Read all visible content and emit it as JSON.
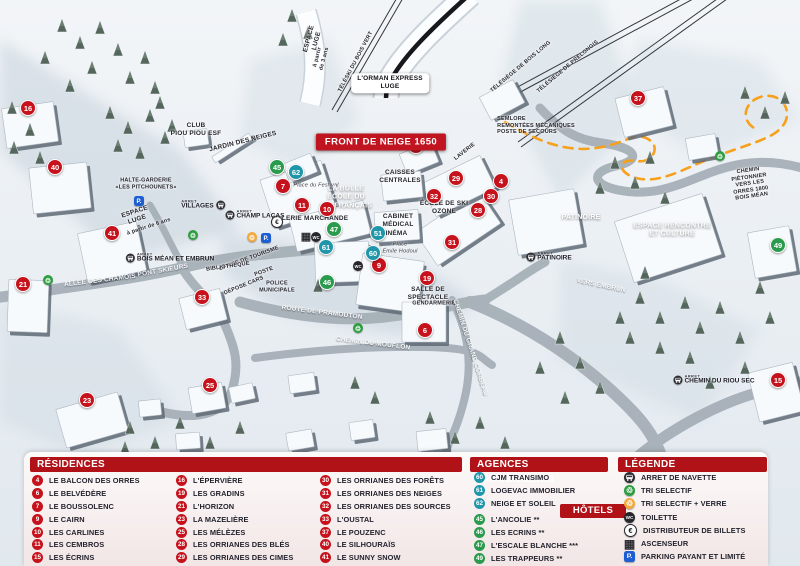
{
  "colors": {
    "header_red": "#b01217",
    "banner_red": "#c01421",
    "marker_red": "#c6121c",
    "marker_green": "#2a9b4c",
    "marker_teal": "#1f96aa",
    "path_orange": "#f6a01b",
    "parking_blue": "#1d5ed2",
    "recycle_green": "#2f9e41",
    "verre_orange": "#f3a93c"
  },
  "map": {
    "banner": {
      "text": "FRONT DE NEIGE 1650"
    },
    "stop_prefix": "ARRET",
    "labels": [
      {
        "t": "ESPACE\nLUGE",
        "x": 313,
        "y": 40,
        "r": -75
      },
      {
        "t": "à partir\nde 3 ans",
        "x": 321,
        "y": 58,
        "r": -75,
        "c": "tiny"
      },
      {
        "t": "TÉLÉSKI DU BOIS VERT",
        "x": 356,
        "y": 62,
        "r": -62,
        "c": "tiny"
      },
      {
        "t": "L'ORMAN EXPRESS\nLUGE",
        "x": 390,
        "y": 83,
        "c": "box"
      },
      {
        "t": "TÉLÉSIÈGE DE BOIS LONG",
        "x": 521,
        "y": 67,
        "r": -40,
        "c": "tiny"
      },
      {
        "t": "TÉLÉSIÈGE DE PRÉLONGIS",
        "x": 568,
        "y": 67,
        "r": -40,
        "c": "tiny"
      },
      {
        "t": "SEMLORE\nREMONTÉES MÉCANIQUES\nPOSTE DE SECOURS",
        "x": 536,
        "y": 126,
        "c": "tiny left"
      },
      {
        "t": "CLUB\nPIOU PIOU ESF",
        "x": 196,
        "y": 130
      },
      {
        "t": "JARDIN DES NEIGES",
        "x": 243,
        "y": 142,
        "r": -14
      },
      {
        "t": "HALTE-GARDERIE\n«LES PITCHOUNETS»",
        "x": 146,
        "y": 184,
        "c": "tiny"
      },
      {
        "t": "ESPACE\nLUGE",
        "x": 136,
        "y": 216,
        "r": -18
      },
      {
        "t": "à partir de 6 ans",
        "x": 149,
        "y": 227,
        "r": -18,
        "c": "tiny"
      },
      {
        "t": "Place du Festival",
        "x": 316,
        "y": 186,
        "c": "place"
      },
      {
        "t": "LA BULLE\nÉCOLE DU\nSKI FRANÇAIS",
        "x": 346,
        "y": 198,
        "c": "white"
      },
      {
        "t": "GALERIE MARCHANDE",
        "x": 310,
        "y": 219
      },
      {
        "t": "OFFICE DE TOURISME",
        "x": 249,
        "y": 259,
        "r": -20,
        "c": "tiny"
      },
      {
        "t": "POSTE",
        "x": 264,
        "y": 272,
        "r": -20,
        "c": "tiny"
      },
      {
        "t": "BIBLIOTHÈQUE",
        "x": 228,
        "y": 267,
        "r": -8,
        "c": "tiny"
      },
      {
        "t": "DÉPOSE CARS",
        "x": 244,
        "y": 286,
        "r": -22,
        "c": "tiny"
      },
      {
        "t": "POLICE\nMUNICIPALE",
        "x": 277,
        "y": 287,
        "c": "tiny"
      },
      {
        "t": "ALLÉE DES CHAMOIS",
        "x": 100,
        "y": 281,
        "r": -7,
        "c": "road"
      },
      {
        "t": "PONT SKIEURS",
        "x": 163,
        "y": 271,
        "r": -10,
        "c": "road"
      },
      {
        "t": "CAISSES\nCENTRALES",
        "x": 400,
        "y": 177
      },
      {
        "t": "LAVERIE",
        "x": 465,
        "y": 152,
        "r": -38,
        "c": "tiny"
      },
      {
        "t": "ÉCOLE DE SKI\nOZONE",
        "x": 444,
        "y": 208
      },
      {
        "t": "CABINET\nMÉDICAL",
        "x": 398,
        "y": 221
      },
      {
        "t": "CINÉMA",
        "x": 394,
        "y": 234
      },
      {
        "t": "Place\nÉmile Hodoul",
        "x": 400,
        "y": 248,
        "c": "place"
      },
      {
        "t": "SALLE DE\nSPECTACLE",
        "x": 428,
        "y": 294
      },
      {
        "t": "GENDARMERIE",
        "x": 434,
        "y": 304,
        "c": "tiny"
      },
      {
        "t": "ROUTE DE PRAMOUTON",
        "x": 322,
        "y": 313,
        "r": 7,
        "c": "road"
      },
      {
        "t": "CHEMIN DU MOUFLON",
        "x": 373,
        "y": 344,
        "r": 7,
        "c": "road"
      },
      {
        "t": "CHEMIN DU GRAND CORBEAU",
        "x": 470,
        "y": 348,
        "r": 72,
        "c": "road"
      },
      {
        "t": "VERS EMBRUN",
        "x": 601,
        "y": 286,
        "r": 12,
        "c": "road"
      },
      {
        "t": "CHEMIN PIÉTONNIER\nVERS LES ORRES 1800\nBOIS MÉAN",
        "x": 750,
        "y": 184,
        "r": -8,
        "c": "tiny"
      },
      {
        "t": "PATINOIRE",
        "x": 581,
        "y": 218,
        "c": "white"
      },
      {
        "t": "ESPACE RENCONTRE\nET CULTURE",
        "x": 672,
        "y": 231,
        "c": "white"
      }
    ],
    "stops": [
      {
        "label": "VILLAGES",
        "x": 203,
        "y": 205,
        "side": "right"
      },
      {
        "label": "CHAMP LACAS",
        "x": 255,
        "y": 215,
        "side": "left"
      },
      {
        "label": "BOIS MÉAN ET EMBRUN",
        "x": 170,
        "y": 258,
        "side": "left"
      },
      {
        "label": "PATINOIRE",
        "x": 549,
        "y": 257,
        "side": "left"
      },
      {
        "label": "CHEMIN DU RIOU SEC",
        "x": 714,
        "y": 380,
        "side": "left"
      }
    ],
    "markers": [
      {
        "n": 16,
        "c": "red",
        "x": 28,
        "y": 108
      },
      {
        "n": 40,
        "c": "red",
        "x": 55,
        "y": 167
      },
      {
        "n": 41,
        "c": "red",
        "x": 112,
        "y": 233
      },
      {
        "n": 21,
        "c": "red",
        "x": 23,
        "y": 284
      },
      {
        "n": 23,
        "c": "red",
        "x": 87,
        "y": 400
      },
      {
        "n": 25,
        "c": "red",
        "x": 210,
        "y": 385
      },
      {
        "n": 33,
        "c": "red",
        "x": 202,
        "y": 297
      },
      {
        "n": 7,
        "c": "red",
        "x": 283,
        "y": 186
      },
      {
        "n": 11,
        "c": "red",
        "x": 302,
        "y": 205
      },
      {
        "n": 10,
        "c": "red",
        "x": 327,
        "y": 209
      },
      {
        "n": 9,
        "c": "red",
        "x": 379,
        "y": 265
      },
      {
        "n": 19,
        "c": "red",
        "x": 427,
        "y": 278
      },
      {
        "n": 6,
        "c": "red",
        "x": 425,
        "y": 330
      },
      {
        "n": 31,
        "c": "red",
        "x": 452,
        "y": 242
      },
      {
        "n": 28,
        "c": "red",
        "x": 478,
        "y": 210
      },
      {
        "n": 30,
        "c": "red",
        "x": 491,
        "y": 196
      },
      {
        "n": 29,
        "c": "red",
        "x": 456,
        "y": 178
      },
      {
        "n": 4,
        "c": "red",
        "x": 501,
        "y": 181
      },
      {
        "n": 32,
        "c": "red",
        "x": 434,
        "y": 196
      },
      {
        "n": 50,
        "c": "red",
        "x": 416,
        "y": 146
      },
      {
        "n": 37,
        "c": "red",
        "x": 638,
        "y": 98
      },
      {
        "n": 15,
        "c": "red",
        "x": 778,
        "y": 380
      },
      {
        "n": 45,
        "c": "green",
        "x": 277,
        "y": 167
      },
      {
        "n": 47,
        "c": "green",
        "x": 334,
        "y": 229
      },
      {
        "n": 46,
        "c": "green",
        "x": 327,
        "y": 282
      },
      {
        "n": 49,
        "c": "green",
        "x": 778,
        "y": 245
      },
      {
        "n": 62,
        "c": "teal",
        "x": 296,
        "y": 172
      },
      {
        "n": 61,
        "c": "teal",
        "x": 326,
        "y": 247
      },
      {
        "n": 51,
        "c": "teal",
        "x": 378,
        "y": 233
      },
      {
        "n": 60,
        "c": "teal",
        "x": 373,
        "y": 253
      }
    ],
    "icons": [
      {
        "t": "recycle",
        "x": 48,
        "y": 280
      },
      {
        "t": "recycle",
        "x": 193,
        "y": 235
      },
      {
        "t": "recycle",
        "x": 358,
        "y": 328
      },
      {
        "t": "recycle",
        "x": 720,
        "y": 156
      },
      {
        "t": "recycle-verre",
        "x": 252,
        "y": 237
      },
      {
        "t": "parking",
        "x": 266,
        "y": 238
      },
      {
        "t": "parking",
        "x": 139,
        "y": 201
      },
      {
        "t": "euro",
        "x": 277,
        "y": 222
      },
      {
        "t": "ascenseur",
        "x": 306,
        "y": 236
      },
      {
        "t": "toilette",
        "x": 316,
        "y": 237
      },
      {
        "t": "toilette",
        "x": 358,
        "y": 266
      }
    ]
  },
  "panel": {
    "residences": {
      "title": "RÉSIDENCES",
      "items": [
        {
          "n": 4,
          "label": "LE BALCON DES ORRES"
        },
        {
          "n": 6,
          "label": "LE BELVÉDÈRE"
        },
        {
          "n": 7,
          "label": "LE BOUSSOLENC"
        },
        {
          "n": 9,
          "label": "LE CAIRN"
        },
        {
          "n": 10,
          "label": "LES CARLINES"
        },
        {
          "n": 11,
          "label": "LES CEMBROS"
        },
        {
          "n": 15,
          "label": "LES ÉCRINS"
        },
        {
          "n": 16,
          "label": "L'ÉPERVIÈRE"
        },
        {
          "n": 19,
          "label": "LES GRADINS"
        },
        {
          "n": 21,
          "label": "L'HORIZON"
        },
        {
          "n": 23,
          "label": "LA MAZELIÈRE"
        },
        {
          "n": 25,
          "label": "LES MÉLÈZES"
        },
        {
          "n": 28,
          "label": "LES ORRIANES DES BLÉS"
        },
        {
          "n": 29,
          "label": "LES ORRIANES DES CIMES"
        },
        {
          "n": 30,
          "label": "LES ORRIANES DES FORÊTS"
        },
        {
          "n": 31,
          "label": "LES ORRIANES DES NEIGES"
        },
        {
          "n": 32,
          "label": "LES ORRIANES DES SOURCES"
        },
        {
          "n": 33,
          "label": "L'OUSTAL"
        },
        {
          "n": 37,
          "label": "LE POUZENC"
        },
        {
          "n": 40,
          "label": "LE SILHOURAÏS"
        },
        {
          "n": 41,
          "label": "LE SUNNY SNOW"
        }
      ]
    },
    "agences": {
      "title": "AGENCES IMMOBILIÈRES",
      "items": [
        {
          "n": 60,
          "label": "CJM TRANSIMO"
        },
        {
          "n": 61,
          "label": "LOGEVAC IMMOBILIER"
        },
        {
          "n": 62,
          "label": "NEIGE ET SOLEIL"
        }
      ]
    },
    "hotels": {
      "title": "HÔTELS",
      "items": [
        {
          "n": 45,
          "label": "L'ANCOLIE **"
        },
        {
          "n": 46,
          "label": "LES ECRINS **"
        },
        {
          "n": 47,
          "label": "L'ESCALE BLANCHE ***"
        },
        {
          "n": 49,
          "label": "LES TRAPPEURS **"
        }
      ]
    },
    "legende": {
      "title": "LÉGENDE",
      "items": [
        {
          "icon": "navette",
          "label": "ARRET DE NAVETTE"
        },
        {
          "icon": "recycle",
          "label": "TRI SELECTIF"
        },
        {
          "icon": "recycle-verre",
          "label": "TRI SELECTIF + VERRE"
        },
        {
          "icon": "toilette",
          "label": "TOILETTE"
        },
        {
          "icon": "euro",
          "label": "DISTRIBUTEUR DE BILLETS"
        },
        {
          "icon": "ascenseur",
          "label": "ASCENSEUR"
        },
        {
          "icon": "parking",
          "label": "PARKING PAYANT ET LIMITÉ"
        }
      ]
    }
  }
}
